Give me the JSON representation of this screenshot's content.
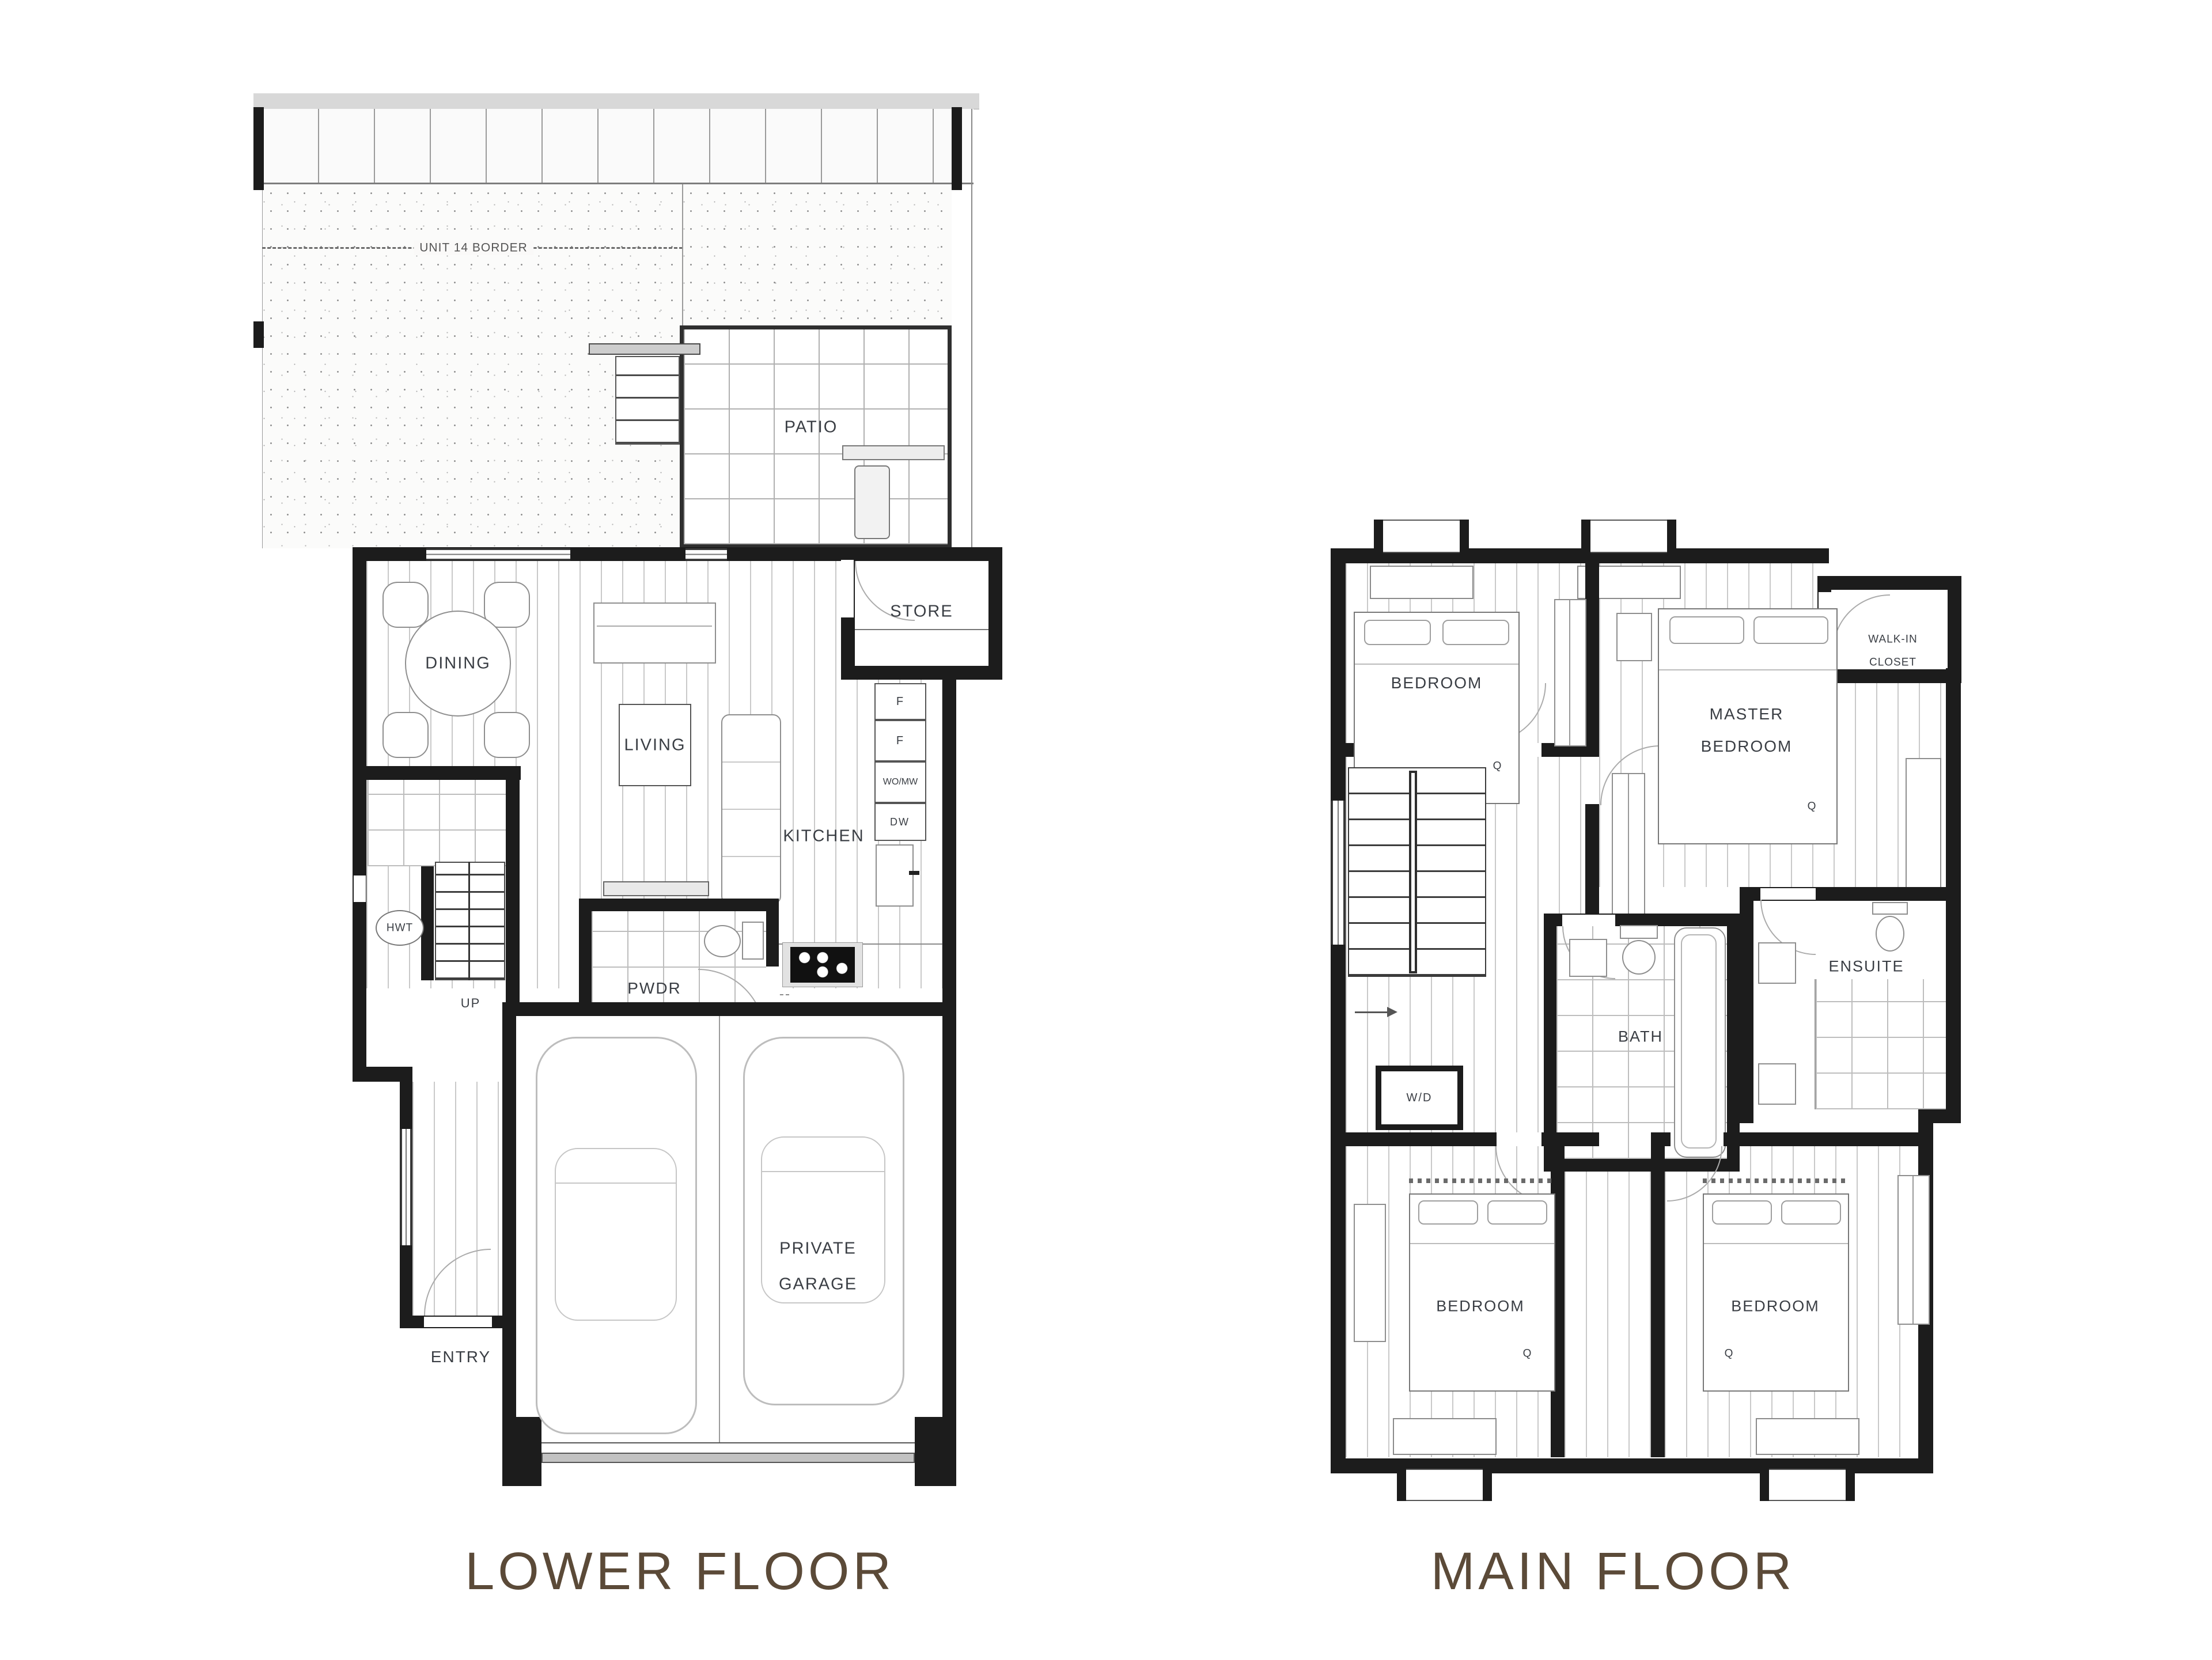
{
  "page": {
    "type": "architectural floor plan sheet"
  },
  "lower_floor": {
    "title": "LOWER FLOOR",
    "site": {
      "unit_border": "UNIT 14 BORDER"
    },
    "rooms": {
      "patio": "PATIO",
      "store": "STORE",
      "dining": "DINING",
      "living": "LIVING",
      "kitchen": "KITCHEN",
      "powder": "PWDR",
      "hot_water_tank": "HWT",
      "stairs_up": "UP",
      "entry": "ENTRY",
      "private_garage": [
        "PRIVATE",
        "GARAGE"
      ]
    },
    "kitchen_appliances": {
      "fridge_1": "F",
      "fridge_2": "F",
      "wall_oven_microwave": "WO/MW",
      "dishwasher": "DW"
    }
  },
  "main_floor": {
    "title": "MAIN FLOOR",
    "rooms": {
      "bedroom_top": "BEDROOM",
      "master_bedroom": [
        "MASTER",
        "BEDROOM"
      ],
      "walk_in_closet": [
        "WALK-IN",
        "CLOSET"
      ],
      "bath": "BATH",
      "ensuite": "ENSUITE",
      "washer_dryer": "W/D",
      "bedroom_bottom_left": "BEDROOM",
      "bedroom_bottom_right": "BEDROOM"
    },
    "bed_marker": "Q"
  },
  "colors": {
    "wall": "#1c1c1c",
    "title_text": "#5b4a38",
    "label_text": "#3a3e44"
  }
}
